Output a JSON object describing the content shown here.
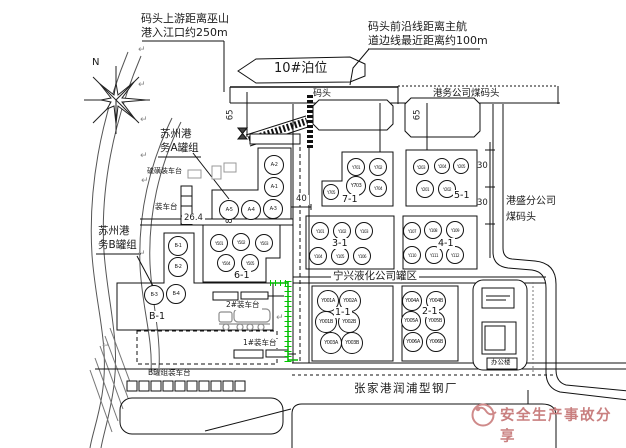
{
  "annotations": {
    "upstream_note": {
      "line1": "码头上游距离巫山",
      "line2": "港入江口约250m"
    },
    "channel_note": {
      "line1": "码头前沿线距离主航",
      "line2": "道边线最近距离约100m"
    },
    "berth": "10#泊位",
    "dock": "码头",
    "coal_dock": "港务公司煤码头",
    "gangsheng": {
      "line1": "港盛分公司",
      "line2": "煤码头"
    },
    "suzhou_a": {
      "line1": "苏州港",
      "line2": "务A罐组"
    },
    "suzhou_b": {
      "line1": "苏州港",
      "line2": "务B罐组"
    },
    "ningxing": "宁兴液化公司罐区",
    "steel_mill": "张家港润浦型钢厂",
    "office": "办公楼",
    "north": "N",
    "sulfur_platform": "硫磺装车台",
    "loading_platform": "装车台",
    "platform_2": "2#装车台",
    "platform_1": "1#装车台",
    "platform_b": "B罐组装车台",
    "watermark": "安全生产事故分享"
  },
  "dimensions": {
    "d65_left": "65",
    "d65_right": "65",
    "d30_a": "30",
    "d30_b": "30",
    "d40": "40",
    "d26": "26.4",
    "d8": "8"
  },
  "colors": {
    "line": "#1a1a1a",
    "green_boundary": "#00b400",
    "watermark_red": "#c98080"
  },
  "glyphs": {
    "return_mark": "↵"
  },
  "return_marks": [
    {
      "x": 138,
      "y": 45
    },
    {
      "x": 138,
      "y": 80
    },
    {
      "x": 140,
      "y": 115
    },
    {
      "x": 140,
      "y": 151
    },
    {
      "x": 141,
      "y": 176
    },
    {
      "x": 138,
      "y": 249
    },
    {
      "x": 276,
      "y": 313
    },
    {
      "x": 102,
      "y": 341
    }
  ],
  "tank_groups": [
    {
      "label": "",
      "label_x": 0,
      "label_y": 0,
      "tanks": [
        {
          "id": "A-2",
          "x": 274,
          "y": 165,
          "r": 10
        },
        {
          "id": "A-1",
          "x": 274,
          "y": 187,
          "r": 10
        },
        {
          "id": "A-3",
          "x": 273,
          "y": 209,
          "r": 10
        },
        {
          "id": "A-4",
          "x": 251,
          "y": 210,
          "r": 10
        },
        {
          "id": "A-5",
          "x": 229,
          "y": 210,
          "r": 10
        }
      ]
    },
    {
      "label": "B-1",
      "label_x": 148,
      "label_y": 311,
      "tanks": [
        {
          "id": "B-1",
          "x": 178,
          "y": 246,
          "r": 10
        },
        {
          "id": "B-2",
          "x": 178,
          "y": 267,
          "r": 10
        },
        {
          "id": "B-3",
          "x": 154,
          "y": 295,
          "r": 10
        },
        {
          "id": "B-4",
          "x": 176,
          "y": 294,
          "r": 10
        }
      ]
    },
    {
      "label": "6-1",
      "label_x": 233,
      "label_y": 270,
      "tanks": [
        {
          "id": "Y501",
          "x": 219,
          "y": 243,
          "r": 9
        },
        {
          "id": "Y502",
          "x": 241,
          "y": 242,
          "r": 9
        },
        {
          "id": "Y503",
          "x": 264,
          "y": 243,
          "r": 9
        },
        {
          "id": "Y504",
          "x": 226,
          "y": 263,
          "r": 9
        },
        {
          "id": "Y505",
          "x": 250,
          "y": 263,
          "r": 9
        }
      ]
    },
    {
      "label": "7-1",
      "label_x": 341,
      "label_y": 194,
      "tanks": [
        {
          "id": "Y701",
          "x": 356,
          "y": 167,
          "r": 9
        },
        {
          "id": "Y702",
          "x": 378,
          "y": 167,
          "r": 9
        },
        {
          "id": "Y703",
          "x": 356,
          "y": 186,
          "r": 10
        },
        {
          "id": "Y704",
          "x": 378,
          "y": 188,
          "r": 9
        },
        {
          "id": "Y705",
          "x": 331,
          "y": 192,
          "r": 8
        }
      ]
    },
    {
      "label": "5-1",
      "label_x": 453,
      "label_y": 190,
      "tanks": [
        {
          "id": "Y203",
          "x": 421,
          "y": 167,
          "r": 8
        },
        {
          "id": "Y204",
          "x": 442,
          "y": 166,
          "r": 8
        },
        {
          "id": "Y205",
          "x": 461,
          "y": 166,
          "r": 8
        },
        {
          "id": "Y201",
          "x": 425,
          "y": 189,
          "r": 9
        },
        {
          "id": "Y202",
          "x": 447,
          "y": 189,
          "r": 9
        }
      ]
    },
    {
      "label": "3-1",
      "label_x": 331,
      "label_y": 238,
      "tanks": [
        {
          "id": "Y101",
          "x": 320,
          "y": 231,
          "r": 9
        },
        {
          "id": "Y102",
          "x": 342,
          "y": 231,
          "r": 9
        },
        {
          "id": "Y103",
          "x": 364,
          "y": 231,
          "r": 9
        },
        {
          "id": "Y104",
          "x": 318,
          "y": 256,
          "r": 9
        },
        {
          "id": "Y105",
          "x": 340,
          "y": 256,
          "r": 9
        },
        {
          "id": "Y106",
          "x": 362,
          "y": 256,
          "r": 9
        }
      ]
    },
    {
      "label": "4-1",
      "label_x": 437,
      "label_y": 238,
      "tanks": [
        {
          "id": "Y107",
          "x": 412,
          "y": 231,
          "r": 9
        },
        {
          "id": "Y108",
          "x": 433,
          "y": 230,
          "r": 9
        },
        {
          "id": "Y109",
          "x": 455,
          "y": 230,
          "r": 9
        },
        {
          "id": "Y110",
          "x": 412,
          "y": 255,
          "r": 9
        },
        {
          "id": "Y111",
          "x": 434,
          "y": 255,
          "r": 9
        },
        {
          "id": "Y112",
          "x": 455,
          "y": 255,
          "r": 9
        }
      ]
    },
    {
      "label": "1-1",
      "label_x": 334,
      "label_y": 307,
      "tanks": [
        {
          "id": "Y001A",
          "x": 328,
          "y": 301,
          "r": 11
        },
        {
          "id": "Y002A",
          "x": 350,
          "y": 301,
          "r": 11
        },
        {
          "id": "Y001B",
          "x": 326,
          "y": 322,
          "r": 11
        },
        {
          "id": "Y002B",
          "x": 349,
          "y": 322,
          "r": 11
        },
        {
          "id": "Y003A",
          "x": 331,
          "y": 343,
          "r": 11
        },
        {
          "id": "Y003B",
          "x": 352,
          "y": 343,
          "r": 11
        }
      ]
    },
    {
      "label": "2-1",
      "label_x": 421,
      "label_y": 306,
      "tanks": [
        {
          "id": "Y004A",
          "x": 412,
          "y": 301,
          "r": 10
        },
        {
          "id": "Y004B",
          "x": 436,
          "y": 301,
          "r": 10
        },
        {
          "id": "Y005A",
          "x": 411,
          "y": 321,
          "r": 10
        },
        {
          "id": "Y005B",
          "x": 435,
          "y": 321,
          "r": 10
        },
        {
          "id": "Y006A",
          "x": 413,
          "y": 342,
          "r": 10
        },
        {
          "id": "Y006B",
          "x": 436,
          "y": 342,
          "r": 10
        }
      ]
    }
  ]
}
